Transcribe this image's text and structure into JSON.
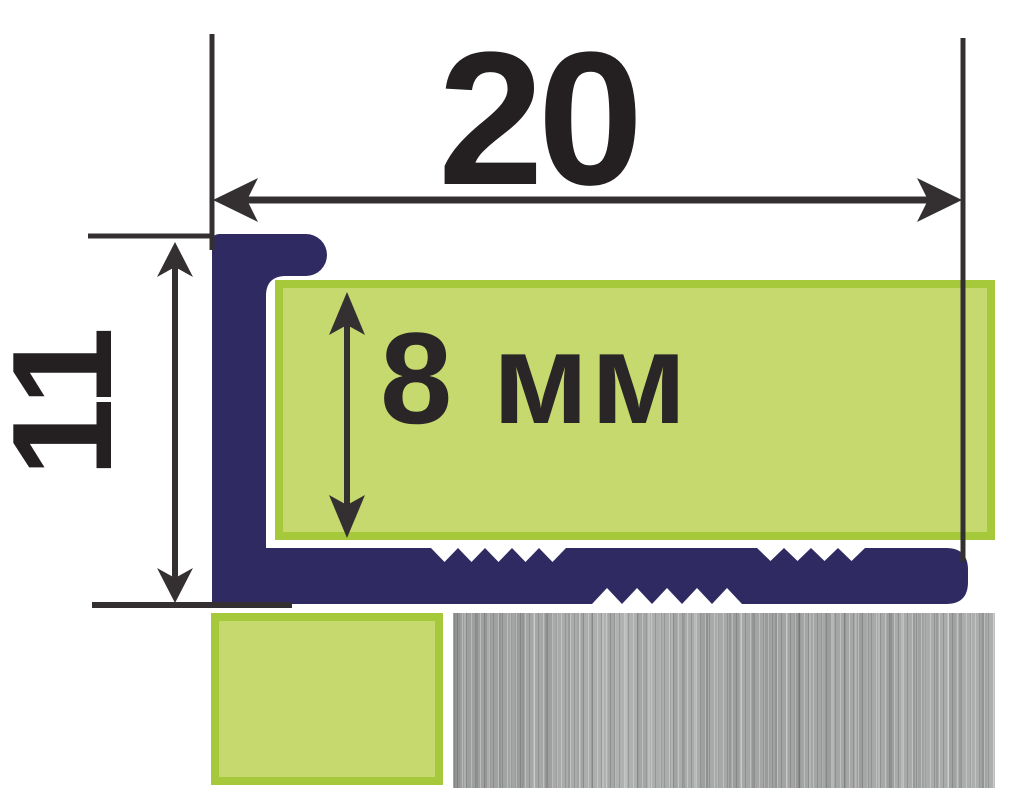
{
  "diagram": {
    "type": "tile-edge-profile-cross-section",
    "width_dimension": "20",
    "height_dimension": "11",
    "tile_thickness": "8 мм"
  },
  "colors": {
    "background": "#ffffff",
    "profile_navy": "#2f2a61",
    "tile_green_fill": "#c6d96e",
    "tile_green_border": "#a6c83b",
    "metal_gray": "#a7a9a8",
    "dimension_lines": "#343031",
    "dimension_text": "#242021"
  }
}
